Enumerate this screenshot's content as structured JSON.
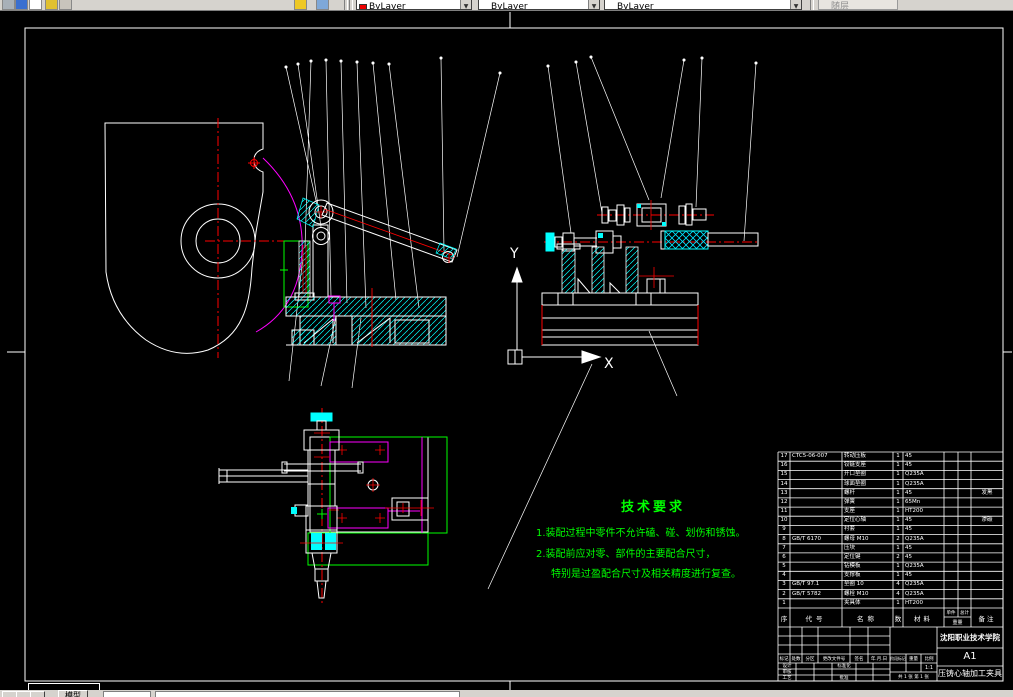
{
  "toolbar": {
    "color_combo": "ByLayer",
    "linetype_combo": "ByLayer",
    "lineweight_combo": "ByLayer",
    "plotstyle_combo": "随层"
  },
  "canvas": {
    "y_label": "Y",
    "x_label": "X"
  },
  "tech_requirements": {
    "title": "技术要求",
    "line1": "1.装配过程中零件不允许磕、碰、划伤和锈蚀。",
    "line2": "2.装配前应对零、部件的主要配合尺寸，",
    "line3": "特别是过盈配合尺寸及相关精度进行复查。"
  },
  "bom": {
    "headers": {
      "seq": "序",
      "code": "代号",
      "name": "名称",
      "qty": "数",
      "material": "材料",
      "unit": "单件",
      "total": "总计",
      "weight": "重量",
      "remark": "备注"
    },
    "rows": [
      {
        "s": "17",
        "c": "CTC5-06-007",
        "n": "转动压板",
        "q": "1",
        "m": "45",
        "r": ""
      },
      {
        "s": "16",
        "c": "",
        "n": "铰链支座",
        "q": "1",
        "m": "45",
        "r": ""
      },
      {
        "s": "15",
        "c": "",
        "n": "开口垫圈",
        "q": "1",
        "m": "Q235A",
        "r": ""
      },
      {
        "s": "14",
        "c": "",
        "n": "球面垫圈",
        "q": "1",
        "m": "Q235A",
        "r": ""
      },
      {
        "s": "13",
        "c": "",
        "n": "螺杆",
        "q": "1",
        "m": "45",
        "r": "发黑"
      },
      {
        "s": "12",
        "c": "",
        "n": "弹簧",
        "q": "1",
        "m": "65Mn",
        "r": ""
      },
      {
        "s": "11",
        "c": "",
        "n": "支座",
        "q": "1",
        "m": "HT200",
        "r": ""
      },
      {
        "s": "10",
        "c": "",
        "n": "定位心轴",
        "q": "1",
        "m": "45",
        "r": "渗碳"
      },
      {
        "s": "9",
        "c": "",
        "n": "衬套",
        "q": "1",
        "m": "45",
        "r": ""
      },
      {
        "s": "8",
        "c": "GB/T 6170",
        "n": "螺母 M10",
        "q": "2",
        "m": "Q235A",
        "r": ""
      },
      {
        "s": "7",
        "c": "",
        "n": "压块",
        "q": "1",
        "m": "45",
        "r": ""
      },
      {
        "s": "6",
        "c": "",
        "n": "定位键",
        "q": "2",
        "m": "45",
        "r": ""
      },
      {
        "s": "5",
        "c": "",
        "n": "钻模板",
        "q": "1",
        "m": "Q235A",
        "r": ""
      },
      {
        "s": "4",
        "c": "",
        "n": "支撑板",
        "q": "1",
        "m": "45",
        "r": ""
      },
      {
        "s": "3",
        "c": "GB/T 97.1",
        "n": "垫圈 10",
        "q": "4",
        "m": "Q235A",
        "r": ""
      },
      {
        "s": "2",
        "c": "GB/T 5782",
        "n": "螺栓 M10",
        "q": "4",
        "m": "Q235A",
        "r": ""
      },
      {
        "s": "1",
        "c": "",
        "n": "夹具体",
        "q": "1",
        "m": "HT200",
        "r": ""
      }
    ]
  },
  "title_block": {
    "school": "沈阳职业技术学院",
    "sheet_size": "A1",
    "drawing_title": "压铸心轴加工夹具",
    "scale_value": "1:1",
    "sheets": "共 1 张  第 1 张",
    "labels": {
      "mark": "标记",
      "count": "处数",
      "zone": "分区",
      "change_file": "更改文件号",
      "signature": "签名",
      "date": "年.月.日",
      "design": "设计",
      "standardization": "标准化",
      "review": "审核",
      "process": "工艺",
      "approve": "批准",
      "stage_mark": "阶段标记",
      "weight": "重量",
      "scale": "比例"
    }
  },
  "statusbar": {
    "model_tab": "模型"
  },
  "colors": {
    "line": "#ffffff",
    "center": "#ff0000",
    "hatch": "#00ffff",
    "aux": "#ff00ff",
    "note": "#00ff00"
  }
}
